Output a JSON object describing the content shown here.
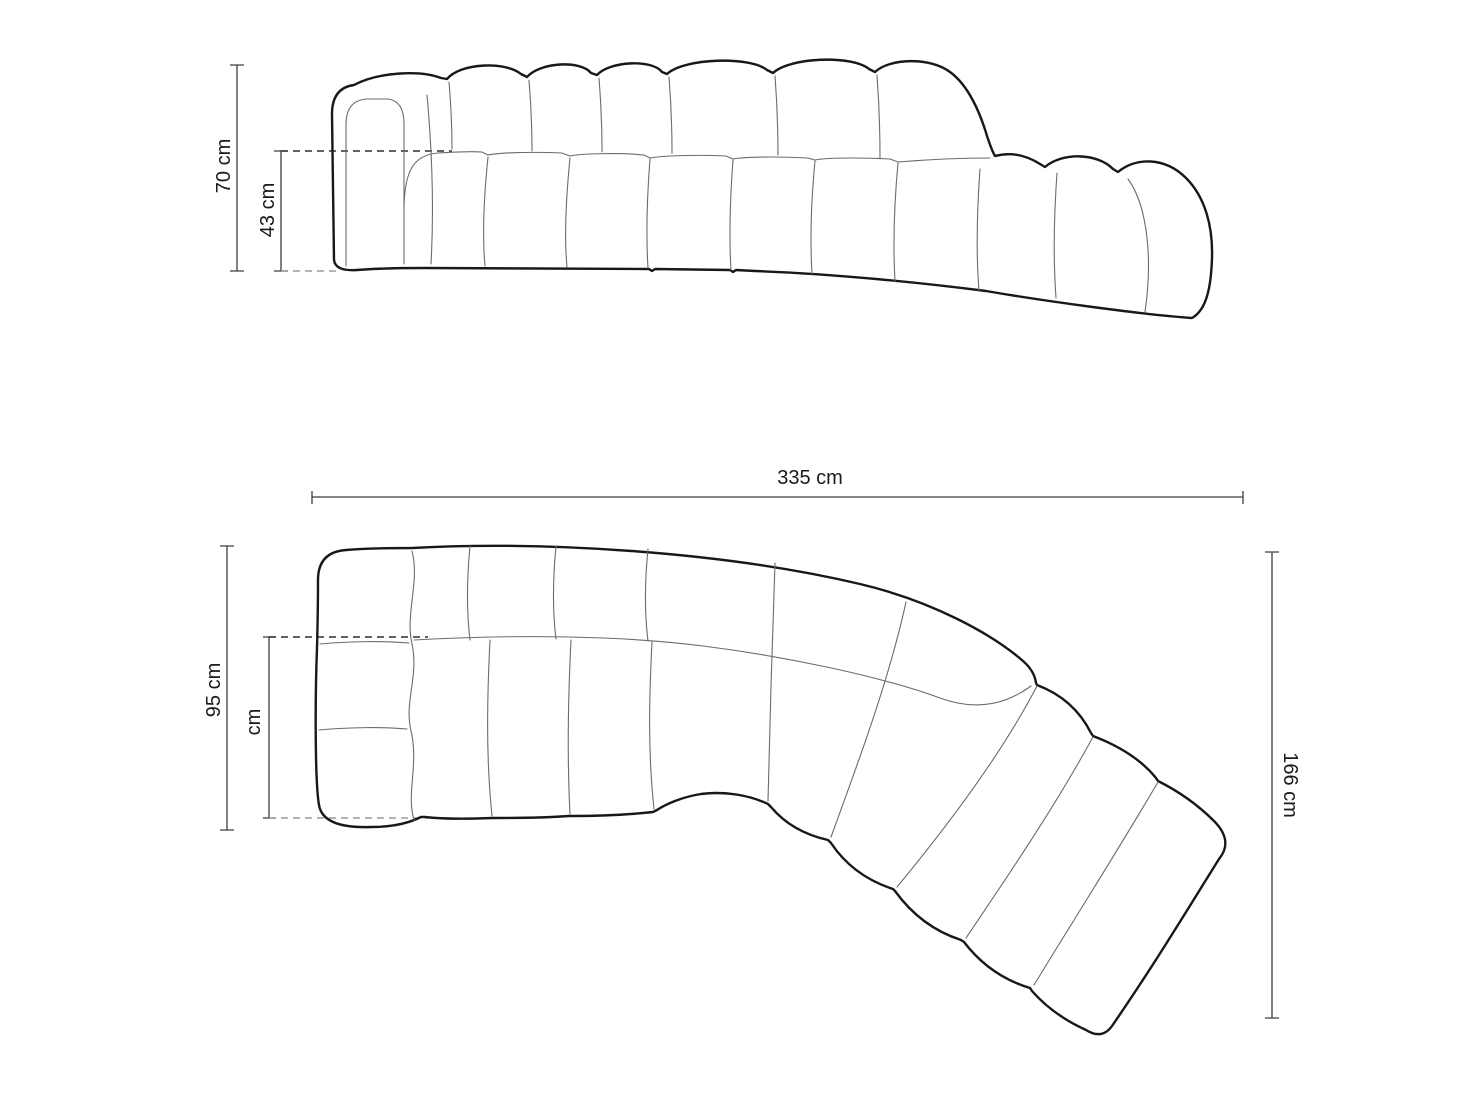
{
  "diagram": {
    "kind": "sofa-dimension-drawing",
    "side_view": {
      "overall_height_label": "70 cm",
      "seat_height_label": "43 cm"
    },
    "plan_view": {
      "overall_width_label": "335 cm",
      "depth_label": "95 cm",
      "seat_depth_label": "cm",
      "chaise_depth_label": "166 cm"
    },
    "dimensions_cm": {
      "overall_height": 70,
      "seat_height": 43,
      "overall_width": 335,
      "depth": 95,
      "chaise_depth": 166
    }
  },
  "colors": {
    "background": "#ffffff",
    "outline": "#181818",
    "thin_line": "#6b6b6b",
    "dimension": "#3d3d3d",
    "dashed_dark": "#2e2e2e",
    "dashed_light": "#9c9c9c",
    "text": "#1a1a1a"
  }
}
